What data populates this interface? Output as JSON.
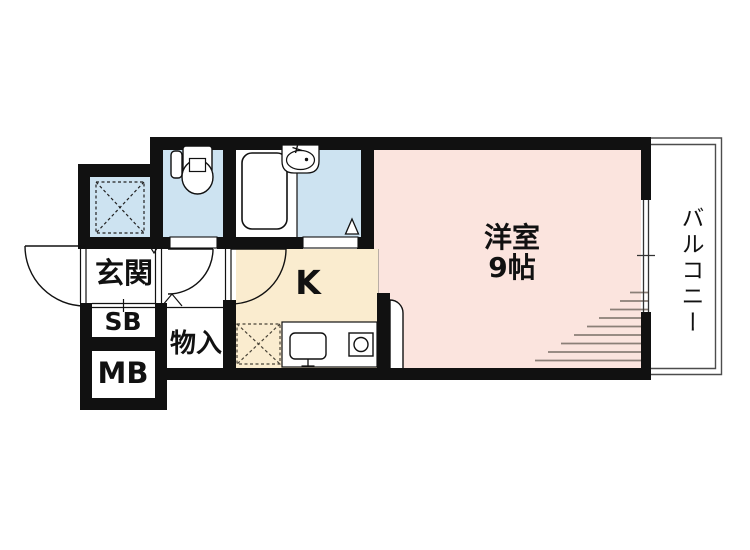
{
  "floorplan": {
    "rooms": {
      "entrance": {
        "label": "玄関"
      },
      "shoe_box": {
        "label": "SB"
      },
      "meter_box": {
        "label": "MB"
      },
      "storage": {
        "label": "物入"
      },
      "kitchen": {
        "label": "K"
      },
      "western_room": {
        "label": "洋室",
        "size": "9帖"
      },
      "balcony": {
        "label": "バルコニー"
      }
    },
    "icons": [
      "toilet-icon",
      "bathtub-icon",
      "washbasin-icon",
      "kitchen-sink-icon",
      "stove-icon",
      "refrigerator-space-icon",
      "storage-hatch-icon",
      "door-swing-icon",
      "sliding-window-icon"
    ],
    "colors": {
      "wall": "#111111",
      "wet_area_fill": "#cde3f1",
      "kitchen_fill": "#faeccf",
      "room_fill": "#fbe4de",
      "hatch_line": "#8b7f77",
      "balcony_line": "#4d4d4d"
    }
  }
}
